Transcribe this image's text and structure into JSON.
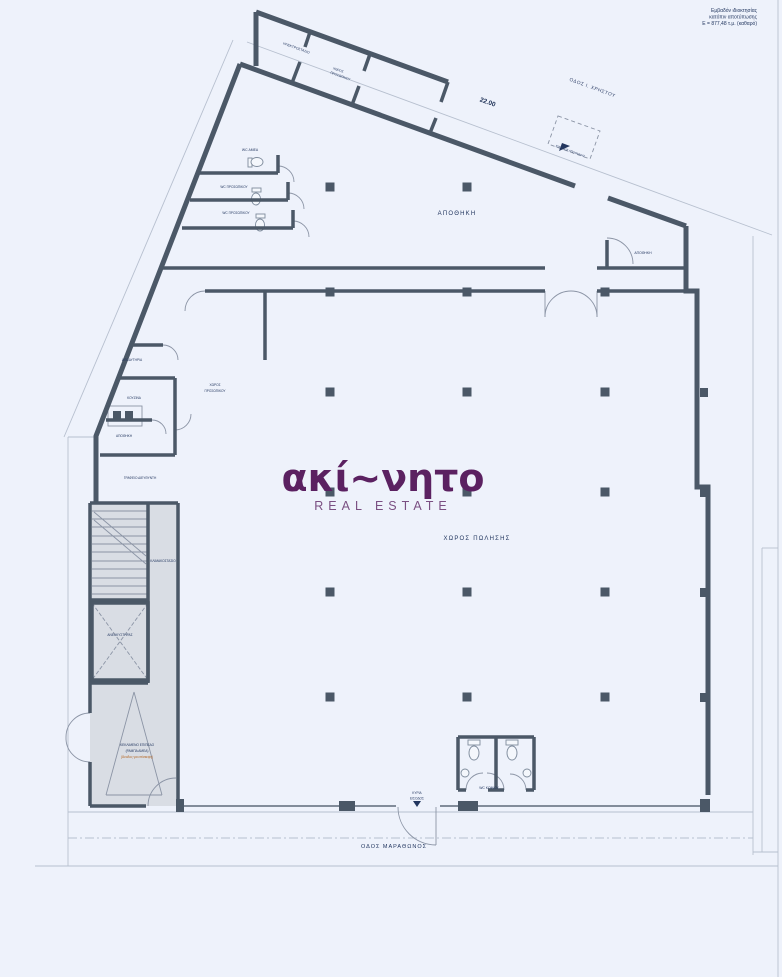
{
  "colors": {
    "paper": "#eef2fb",
    "wall": "#4b5867",
    "label_navy": "#22365f",
    "brand_purple": "#5b2161",
    "brand_subtitle_purple": "#7a4f82",
    "ramp_note_orange": "#b4641e"
  },
  "site_note": {
    "line1": "Εμβαδόν ιδιοκτησίας",
    "line2": "κατόπιν αποτύπωσης",
    "line3": "Ε = 877,48 τ.μ. (καθαρό)"
  },
  "streets": {
    "top_street": "ΟΔΟΣ Ι. ΧΡΗΣΤΟΥ",
    "bottom_street": "ΟΔΟΣ ΜΑΡΑΘΩΝΟΣ"
  },
  "dimensions": {
    "top_wall_length": "22.00"
  },
  "watermark": {
    "brand": "ακί~νητο",
    "subtitle": "REAL ESTATE"
  },
  "rooms": {
    "warehouse": "ΑΠΟΘΗΚΗ",
    "sales_area": "ΧΩΡΟΣ ΠΩΛΗΣΗΣ",
    "storage_top_right": "ΑΠΟΘΗΚΗ",
    "electrical_room": "ΗΛΕΚΤΡΟΣΤΑΣΙΟ",
    "staff_room_top_line1": "ΧΩΡΟΣ",
    "staff_room_top_line2": "ΠΡΟΣΩΠΙΚΟΥ",
    "wc_accessible": "WC ΑΜΕΑ",
    "wc_staff_1": "WC ΠΡΟΣΩΠΙΚΟΥ",
    "wc_staff_2": "WC ΠΡΟΣΩΠΙΚΟΥ",
    "changing_room": "ΑΠΟΔΥΤΗΡΙΑ",
    "kitchen": "ΚΟΥΖΙΝΑ",
    "staff_room_left_line1": "ΧΩΡΟΣ",
    "staff_room_left_line2": "ΠΡΟΣΩΠΙΚΟΥ",
    "storage_left": "ΑΠΟΘΗΚΗ",
    "managers_office": "ΓΡΑΦΕΙΟ ΔΙΕΥΘΥΝΤΗ",
    "staircase": "ΚΛΙΜΑΚΟΣΤΑΣΙΟ",
    "elevator": "ΑΝΕΛΚΥΣΤΗΡΑΣ",
    "wc_public": "WC ΚΟΙΝΟΥ"
  },
  "annotations": {
    "ramp_line1": "ΚΕΚΛΙΜΕΝΟ ΕΠΙΠΕΔΟ",
    "ramp_line2": "(ΡΑΜΠΑ ΑΜΕΑ)",
    "ramp_line3": "(Άνοδος για επίσκεψη)",
    "main_entrance_line1": "ΚΥΡΙΑ",
    "main_entrance_line2": "ΕΙΣΟΔΟΣ",
    "warehouse_entrance": "ΕΙΣΟΔΟΣ ΑΠΟΘΗΚΗΣ"
  }
}
